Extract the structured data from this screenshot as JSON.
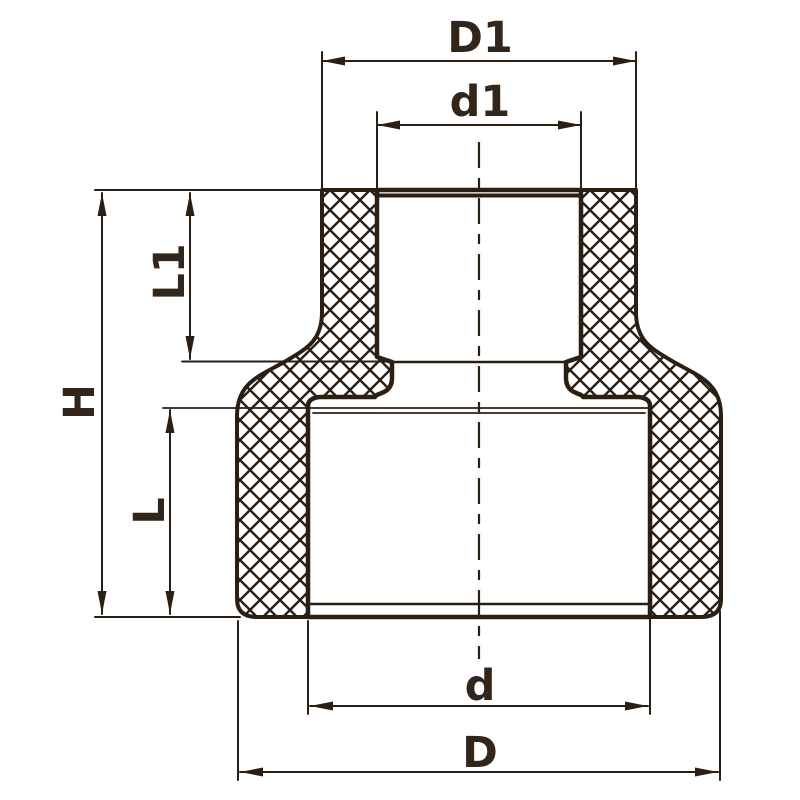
{
  "drawing": {
    "type": "technical-drawing",
    "subject": "reducing coupling pipe fitting cross-section with dimension callouts",
    "colors": {
      "line": "#2b1f14",
      "label": "#32251a",
      "background": "#ffffff"
    },
    "dimension_labels": {
      "upper_outer_diameter": "D1",
      "upper_inner_diameter": "d1",
      "upper_socket_depth": "L1",
      "overall_height": "H",
      "lower_socket_depth": "L",
      "lower_inner_diameter": "d",
      "lower_outer_diameter": "D"
    }
  }
}
